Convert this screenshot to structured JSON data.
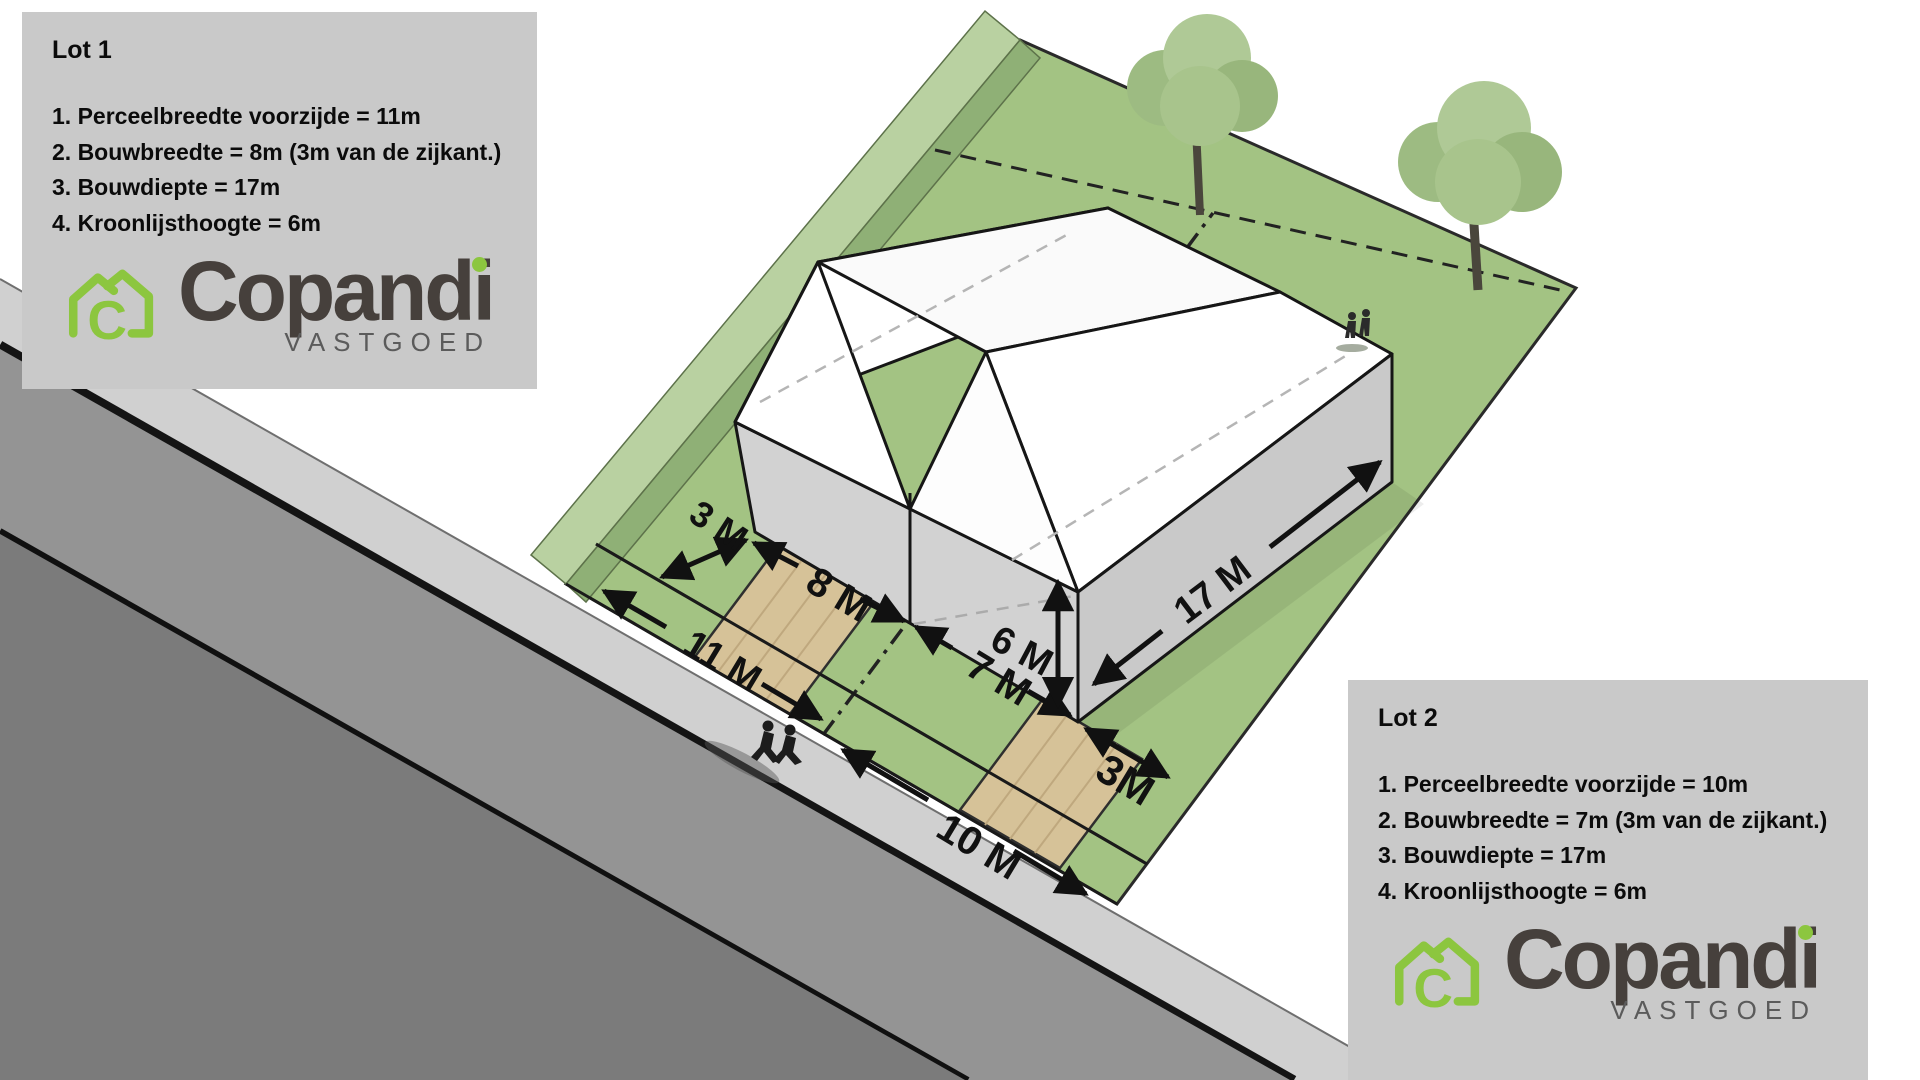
{
  "colors": {
    "brand_green": "#8CC63F",
    "brand_dark": "#46403C",
    "brand_gray": "#5B5B5B",
    "box_bg": "#C9C9C9",
    "grass": "#A3C383",
    "berm_light": "#B9D1A1",
    "road_asphalt": "#949494",
    "road_lower": "#7B7B7B",
    "sidewalk": "#D0D0D0",
    "path_tan": "#D6C298",
    "building_wall": "#D2D2D2",
    "roof_white": "#FFFFFF"
  },
  "lot1": {
    "title": "Lot 1",
    "lines": [
      "1. Perceelbreedte voorzijde = 11m",
      "2. Bouwbreedte = 8m (3m van de zijkant.)",
      "3. Bouwdiepte = 17m",
      "4. Kroonlijsthoogte = 6m"
    ]
  },
  "lot2": {
    "title": "Lot 2",
    "lines": [
      "1. Perceelbreedte voorzijde = 10m",
      "2. Bouwbreedte = 7m (3m van de zijkant.)",
      "3. Bouwdiepte = 17m",
      "4. Kroonlijsthoogte = 6m"
    ]
  },
  "brand": {
    "main": "Copand",
    "i_letter": "i",
    "monogram": "C",
    "sub": "VASTGOED"
  },
  "dimensions": {
    "setback_left": "3 M",
    "build_width_lot1": "8 M",
    "frontage_lot1": "11 M",
    "build_width_lot2": "7 M",
    "eave_height": "6 M",
    "build_depth": "17 M",
    "setback_right": "3M",
    "frontage_lot2": "10 M"
  }
}
